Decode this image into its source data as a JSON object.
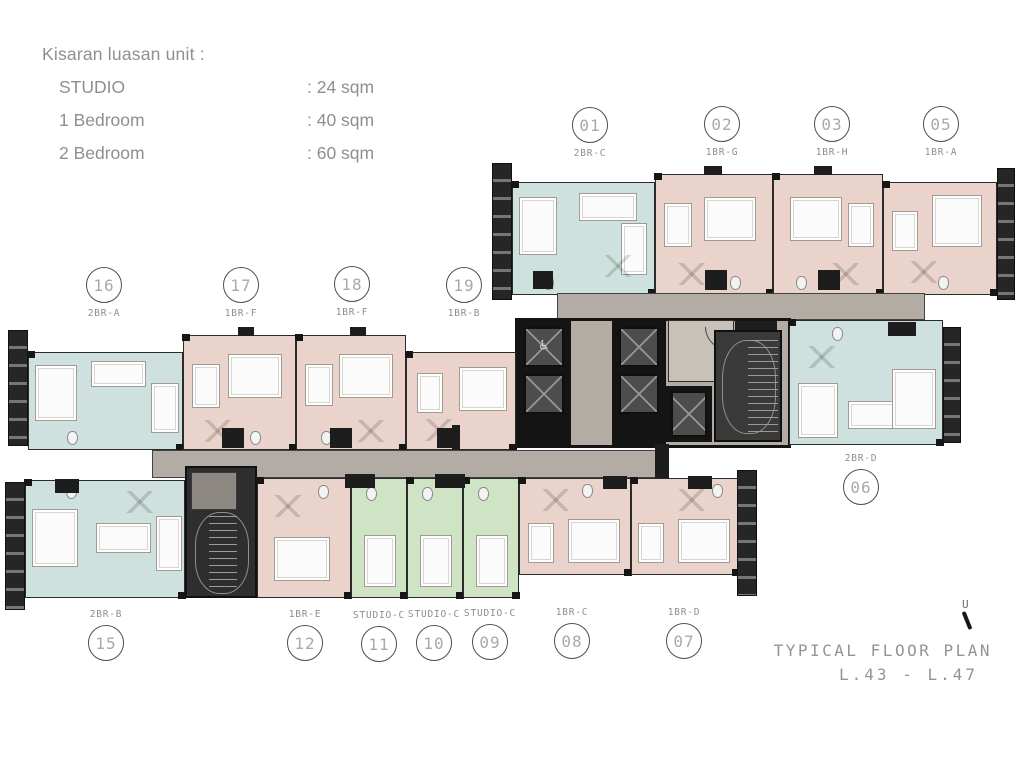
{
  "legend": {
    "title": "Kisaran luasan unit :",
    "items": [
      {
        "label": "STUDIO",
        "value": ": 24 sqm"
      },
      {
        "label": "1 Bedroom",
        "value": ": 40 sqm"
      },
      {
        "label": "2 Bedroom",
        "value": ": 60 sqm"
      }
    ]
  },
  "title_block": {
    "line1": "TYPICAL FLOOR PLAN",
    "line2": "L.43 - L.47",
    "north_label": "U"
  },
  "unit_markers": [
    {
      "number": "01",
      "type": "2BR-C",
      "cx": 590,
      "cy": 125,
      "label_pos": "below"
    },
    {
      "number": "02",
      "type": "1BR-G",
      "cx": 722,
      "cy": 124,
      "label_pos": "below"
    },
    {
      "number": "03",
      "type": "1BR-H",
      "cx": 832,
      "cy": 124,
      "label_pos": "below"
    },
    {
      "number": "05",
      "type": "1BR-A",
      "cx": 941,
      "cy": 124,
      "label_pos": "below"
    },
    {
      "number": "16",
      "type": "2BR-A",
      "cx": 104,
      "cy": 285,
      "label_pos": "below"
    },
    {
      "number": "17",
      "type": "1BR-F",
      "cx": 241,
      "cy": 285,
      "label_pos": "below"
    },
    {
      "number": "18",
      "type": "1BR-F",
      "cx": 352,
      "cy": 284,
      "label_pos": "below"
    },
    {
      "number": "19",
      "type": "1BR-B",
      "cx": 464,
      "cy": 285,
      "label_pos": "below"
    },
    {
      "number": "06",
      "type": "2BR-D",
      "cx": 861,
      "cy": 487,
      "label_pos": "above"
    },
    {
      "number": "15",
      "type": "2BR-B",
      "cx": 106,
      "cy": 643,
      "label_pos": "above"
    },
    {
      "number": "12",
      "type": "1BR-E",
      "cx": 305,
      "cy": 643,
      "label_pos": "above"
    },
    {
      "number": "11",
      "type": "STUDIO-C",
      "cx": 379,
      "cy": 644,
      "label_pos": "above"
    },
    {
      "number": "10",
      "type": "STUDIO-C",
      "cx": 434,
      "cy": 643,
      "label_pos": "above"
    },
    {
      "number": "09",
      "type": "STUDIO-C",
      "cx": 490,
      "cy": 642,
      "label_pos": "above"
    },
    {
      "number": "08",
      "type": "1BR-C",
      "cx": 572,
      "cy": 641,
      "label_pos": "above"
    },
    {
      "number": "07",
      "type": "1BR-D",
      "cx": 684,
      "cy": 641,
      "label_pos": "above"
    }
  ],
  "colors": {
    "unit-pink": "#ead3ca",
    "unit-blue": "#cfe1de",
    "unit-green": "#cfe3c5",
    "corridor": "#b3aca5"
  },
  "icons": {
    "accessible_icon": "♿"
  }
}
